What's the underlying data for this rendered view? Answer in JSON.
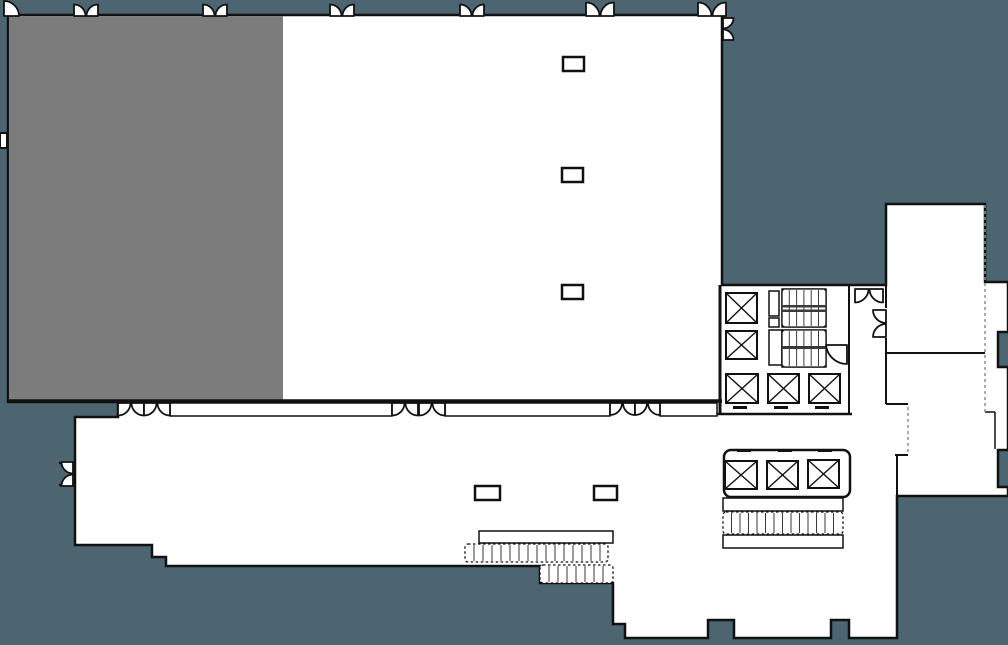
{
  "floor_plan": {
    "colors": {
      "background": "#4C6570",
      "highlighted_room": "#7C7C7C",
      "floor": "#FFFFFF",
      "wall": "#111111",
      "tread_line": "#3A3A3A",
      "dashed_wall": "#8F8F8F"
    },
    "rooms": {
      "highlighted_section": "shaded ballroom section (selected)",
      "open_section": "unshaded ballroom section",
      "lower_hall": "prefunction lobby",
      "core": "elevator and stair core",
      "right_rooms": "two rooms at right wing"
    },
    "walls": [
      {
        "x1": 8,
        "y1": 401,
        "x2": 722,
        "y2": 401,
        "w": 3.5
      },
      {
        "x1": 720,
        "y1": 285,
        "x2": 720,
        "y2": 414,
        "w": 3
      },
      {
        "x1": 714,
        "y1": 414,
        "x2": 852,
        "y2": 414,
        "w": 2.5
      },
      {
        "x1": 849,
        "y1": 286,
        "x2": 849,
        "y2": 414,
        "w": 2
      },
      {
        "x1": 886,
        "y1": 204,
        "x2": 886,
        "y2": 308,
        "w": 2
      },
      {
        "x1": 886,
        "y1": 338,
        "x2": 886,
        "y2": 353,
        "w": 2
      },
      {
        "x1": 886,
        "y1": 353,
        "x2": 985,
        "y2": 353,
        "w": 2
      },
      {
        "x1": 886,
        "y1": 353,
        "x2": 886,
        "y2": 404,
        "w": 2
      },
      {
        "x1": 886,
        "y1": 404,
        "x2": 908,
        "y2": 404,
        "w": 2
      },
      {
        "x1": 895,
        "y1": 455,
        "x2": 908,
        "y2": 455,
        "w": 2
      },
      {
        "x1": 897,
        "y1": 455,
        "x2": 897,
        "y2": 497,
        "w": 2
      },
      {
        "x1": 985,
        "y1": 412,
        "x2": 995,
        "y2": 412,
        "w": 1.5
      },
      {
        "x1": 995,
        "y1": 412,
        "x2": 995,
        "y2": 449,
        "w": 1.5
      },
      {
        "x1": 59,
        "y1": 463,
        "x2": 73,
        "y2": 463,
        "w": 2.5
      },
      {
        "x1": 59,
        "y1": 485,
        "x2": 73,
        "y2": 485,
        "w": 2.5
      }
    ],
    "dashed_walls": [
      {
        "x1": 985,
        "y1": 205,
        "x2": 985,
        "y2": 412
      },
      {
        "x1": 908,
        "y1": 407,
        "x2": 908,
        "y2": 453
      }
    ],
    "feature_rects": [
      {
        "name": "operable-wall",
        "x": 170,
        "y": 403,
        "w": 222,
        "h": 13,
        "sw": 1.5
      },
      {
        "name": "operable-wall",
        "x": 445,
        "y": 403,
        "w": 165,
        "h": 13,
        "sw": 1.5
      },
      {
        "name": "operable-wall",
        "x": 660,
        "y": 403,
        "w": 57,
        "h": 13,
        "sw": 1.5
      },
      {
        "name": "escalator-rail",
        "x": 479,
        "y": 531,
        "w": 134,
        "h": 12,
        "sw": 1.5
      },
      {
        "name": "shaft",
        "x": 769,
        "y": 291,
        "w": 10,
        "h": 25,
        "sw": 1.5
      },
      {
        "name": "shaft",
        "x": 769,
        "y": 318,
        "w": 10,
        "h": 9,
        "sw": 1.5
      },
      {
        "name": "stair-vestibule",
        "x": 769,
        "y": 330,
        "w": 13,
        "h": 35,
        "sw": 1.5
      },
      {
        "name": "stair-outline",
        "x": 782,
        "y": 289,
        "w": 44,
        "h": 38,
        "sw": 1.5
      },
      {
        "name": "stair-outline",
        "x": 782,
        "y": 330,
        "w": 44,
        "h": 37,
        "sw": 1.5
      },
      {
        "name": "stair-landing",
        "x": 723,
        "y": 498,
        "w": 120,
        "h": 13,
        "sw": 1.5
      },
      {
        "name": "stair-landing",
        "x": 723,
        "y": 535,
        "w": 120,
        "h": 13,
        "sw": 1.5
      },
      {
        "name": "elevator-bank-enclosure",
        "x": 724,
        "y": 450,
        "w": 126,
        "h": 47,
        "sw": 2.5,
        "rx": 7
      },
      {
        "name": "wall-niche",
        "x": 0,
        "y": 133,
        "w": 7,
        "h": 15,
        "sw": 2
      }
    ],
    "columns": [
      {
        "x": 563,
        "y": 57,
        "w": 21,
        "h": 14
      },
      {
        "x": 562,
        "y": 168,
        "w": 21,
        "h": 14
      },
      {
        "x": 562,
        "y": 285,
        "w": 21,
        "h": 14
      },
      {
        "x": 475,
        "y": 486,
        "w": 25,
        "h": 14
      },
      {
        "x": 594,
        "y": 486,
        "w": 23,
        "h": 14
      }
    ],
    "elevators": [
      {
        "x": 726,
        "y": 293,
        "w": 31,
        "h": 30
      },
      {
        "x": 726,
        "y": 331,
        "w": 31,
        "h": 28
      },
      {
        "x": 726,
        "y": 374,
        "w": 32,
        "h": 29
      },
      {
        "x": 768,
        "y": 374,
        "w": 31,
        "h": 29
      },
      {
        "x": 809,
        "y": 374,
        "w": 31,
        "h": 29
      },
      {
        "x": 725,
        "y": 461,
        "w": 32,
        "h": 28
      },
      {
        "x": 767,
        "y": 461,
        "w": 31,
        "h": 28
      },
      {
        "x": 808,
        "y": 460,
        "w": 31,
        "h": 28
      }
    ],
    "stair_banks": [
      {
        "name": "escalator-treads",
        "x": 465,
        "y": 544,
        "w": 143,
        "h": 18,
        "sp": 9,
        "dashed": true
      },
      {
        "name": "escalator-treads",
        "x": 540,
        "y": 565,
        "w": 73,
        "h": 18,
        "sp": 9,
        "dashed": true
      },
      {
        "name": "core-stair-treads",
        "x": 723,
        "y": 512,
        "w": 120,
        "h": 22,
        "sp": 8.5,
        "dashed": true
      },
      {
        "name": "stair-treads",
        "x": 782,
        "y": 289,
        "w": 44,
        "h": 38,
        "sp": 7.3,
        "dashed": false
      },
      {
        "name": "stair-treads",
        "x": 782,
        "y": 330,
        "w": 44,
        "h": 37,
        "sp": 7.3,
        "dashed": false
      }
    ],
    "rail_bars": [
      {
        "x": 782,
        "y": 305,
        "w": 44,
        "h": 2.5
      },
      {
        "x": 782,
        "y": 309.5,
        "w": 44,
        "h": 2.5
      },
      {
        "x": 782,
        "y": 346,
        "w": 44,
        "h": 3
      }
    ],
    "door_marks": [
      {
        "x": 733,
        "y": 406,
        "w": 14,
        "h": 3
      },
      {
        "x": 774,
        "y": 406,
        "w": 14,
        "h": 3
      },
      {
        "x": 815,
        "y": 406,
        "w": 14,
        "h": 3
      },
      {
        "x": 737,
        "y": 449,
        "w": 14,
        "h": 3
      },
      {
        "x": 778,
        "y": 449,
        "w": 14,
        "h": 3
      },
      {
        "x": 818,
        "y": 449,
        "w": 14,
        "h": 3
      }
    ],
    "doors": [
      {
        "type": "single",
        "dir": "N",
        "x": 4,
        "y": 16,
        "r": 15
      },
      {
        "type": "double",
        "dir": "N",
        "x0": 74,
        "x1": 98,
        "y": 16
      },
      {
        "type": "double",
        "dir": "N",
        "x0": 203,
        "x1": 227,
        "y": 16
      },
      {
        "type": "double",
        "dir": "N",
        "x0": 330,
        "x1": 354,
        "y": 16
      },
      {
        "type": "double",
        "dir": "N",
        "x0": 460,
        "x1": 484,
        "y": 16
      },
      {
        "type": "double",
        "dir": "N",
        "x0": 586,
        "x1": 614,
        "y": 16
      },
      {
        "type": "double",
        "dir": "N",
        "x0": 698,
        "x1": 726,
        "y": 16
      },
      {
        "type": "double",
        "dir": "E",
        "x": 723,
        "y0": 18,
        "y1": 40
      },
      {
        "type": "double",
        "dir": "S",
        "x0": 118,
        "x1": 144,
        "y": 403
      },
      {
        "type": "double",
        "dir": "S",
        "x0": 144,
        "x1": 170,
        "y": 403
      },
      {
        "type": "double",
        "dir": "S",
        "x0": 392,
        "x1": 418,
        "y": 403
      },
      {
        "type": "double",
        "dir": "S",
        "x0": 419,
        "x1": 445,
        "y": 403
      },
      {
        "type": "double",
        "dir": "S",
        "x0": 610,
        "x1": 635,
        "y": 403
      },
      {
        "type": "double",
        "dir": "S",
        "x0": 635,
        "x1": 660,
        "y": 403
      },
      {
        "type": "double",
        "dir": "S",
        "x0": 855,
        "x1": 883,
        "y": 289
      },
      {
        "type": "double",
        "dir": "W",
        "x": 73,
        "y0": 462,
        "y1": 486
      },
      {
        "type": "double",
        "dir": "W",
        "x": 886,
        "y0": 310,
        "y1": 337
      },
      {
        "type": "leaf",
        "path": "M826,345 A21,21 0 0 0 847,364 L847,345 Z"
      }
    ]
  }
}
